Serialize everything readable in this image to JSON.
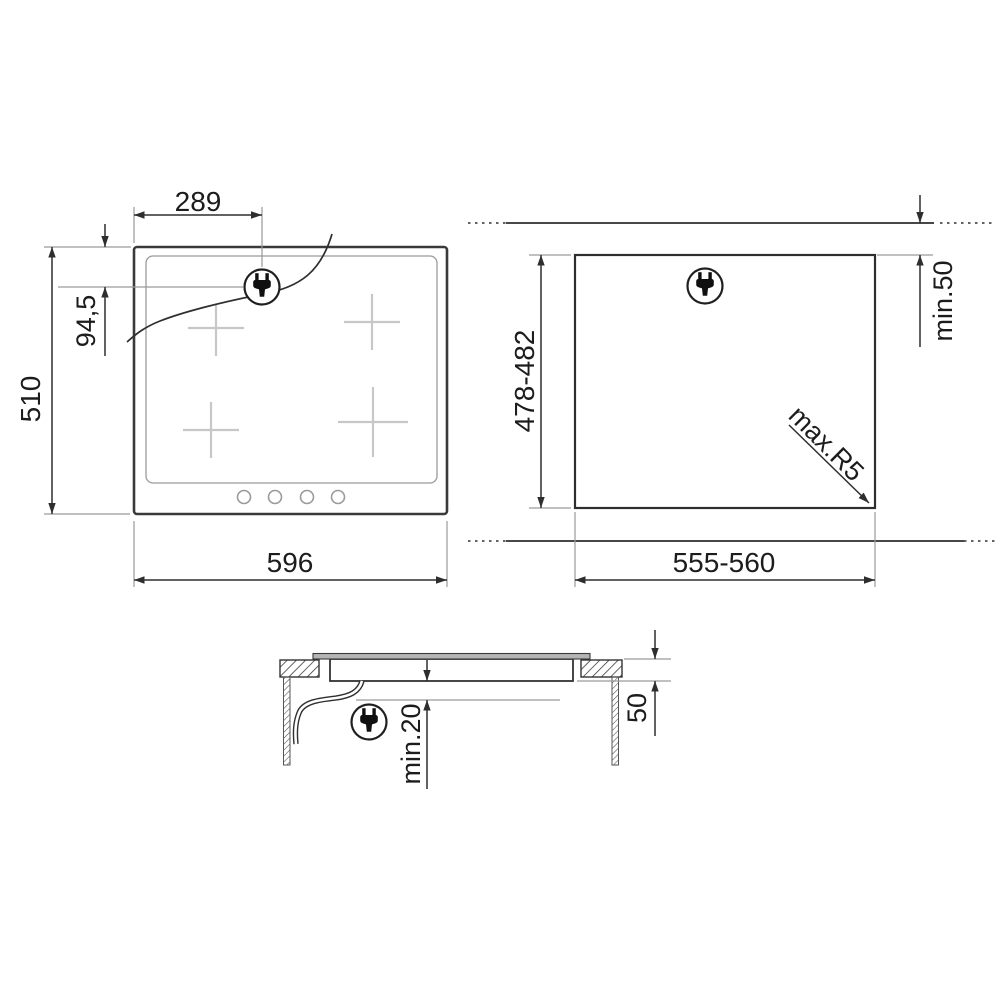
{
  "views": {
    "plan": {
      "dims": {
        "plug_offset_x": "289",
        "plug_offset_y": "94,5",
        "overall_depth": "510",
        "overall_width": "596"
      }
    },
    "cutout": {
      "dims": {
        "cutout_depth": "478-482",
        "rear_clearance": "min.50",
        "corner_radius": "max.R5",
        "cutout_width": "555-560"
      }
    },
    "section": {
      "dims": {
        "under_clearance": "min.20",
        "recess_depth": "50"
      }
    }
  },
  "colors": {
    "line": "#2e2e2e",
    "outline": "#3a3a3a",
    "extension": "#9a9a9a",
    "zone_mark": "#c7c7c7",
    "glass": "#b4b4b4",
    "text": "#1c1c1c",
    "background": "#ffffff"
  }
}
